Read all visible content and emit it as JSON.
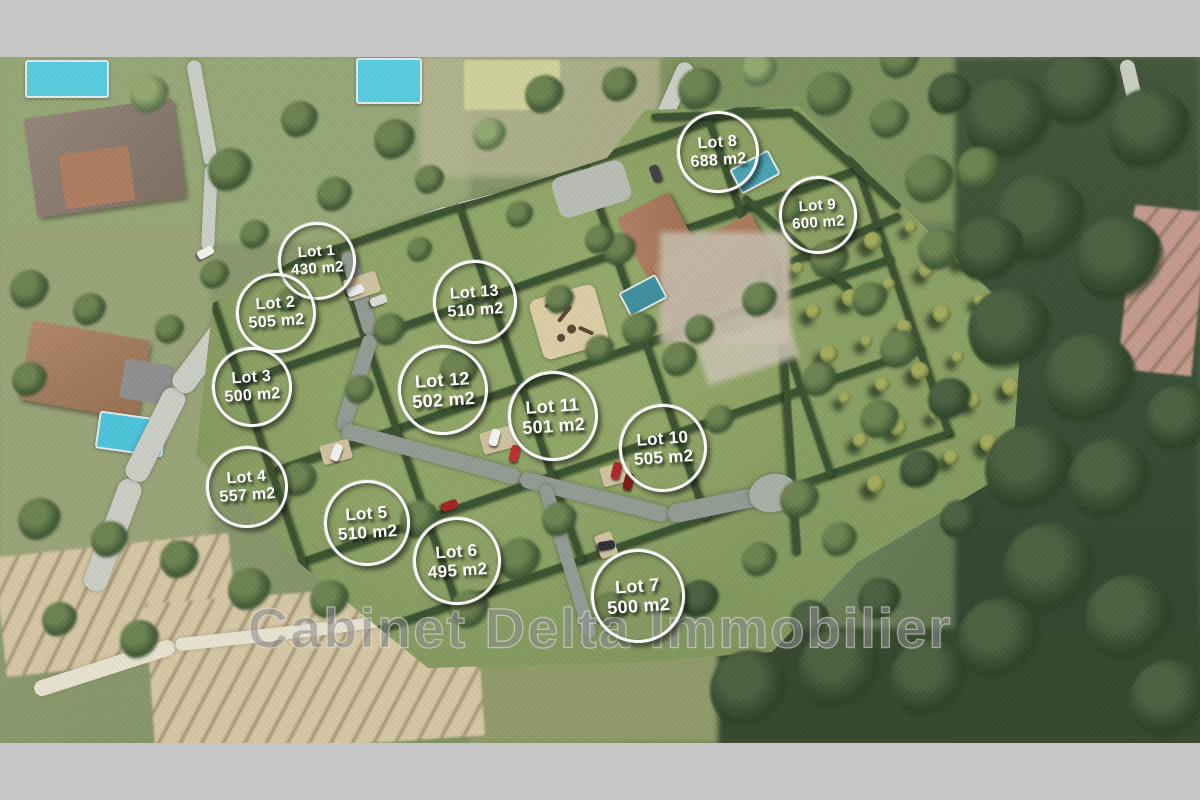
{
  "watermark": {
    "text": "Cabinet Delta Immobilier"
  },
  "lots": [
    {
      "label": "Lot 1",
      "area": "430 m2",
      "x": 317,
      "y": 261,
      "d": 72
    },
    {
      "label": "Lot 2",
      "area": "505 m2",
      "x": 276,
      "y": 313,
      "d": 74
    },
    {
      "label": "Lot 3",
      "area": "500 m2",
      "x": 252,
      "y": 387,
      "d": 74
    },
    {
      "label": "Lot 4",
      "area": "557 m2",
      "x": 247,
      "y": 487,
      "d": 76
    },
    {
      "label": "Lot 5",
      "area": "510 m2",
      "x": 367,
      "y": 523,
      "d": 80
    },
    {
      "label": "Lot 6",
      "area": "495 m2",
      "x": 457,
      "y": 561,
      "d": 82
    },
    {
      "label": "Lot 7",
      "area": "500 m2",
      "x": 638,
      "y": 596,
      "d": 88
    },
    {
      "label": "Lot 8",
      "area": "688 m2",
      "x": 718,
      "y": 152,
      "d": 76
    },
    {
      "label": "Lot 9",
      "area": "600 m2",
      "x": 818,
      "y": 215,
      "d": 72
    },
    {
      "label": "Lot 10",
      "area": "505 m2",
      "x": 663,
      "y": 448,
      "d": 82
    },
    {
      "label": "Lot 11",
      "area": "501 m2",
      "x": 553,
      "y": 416,
      "d": 84
    },
    {
      "label": "Lot 12",
      "area": "502 m2",
      "x": 443,
      "y": 390,
      "d": 84
    },
    {
      "label": "Lot 13",
      "area": "510 m2",
      "x": 475,
      "y": 302,
      "d": 78
    }
  ],
  "colors": {
    "frame": "#c6c6c6",
    "lawn": "#81985e",
    "hedge": "#3a5230",
    "forest": "#3f5638",
    "road_public": "#cbcec5",
    "road_internal": "#929c94",
    "field": "#d6c7a4",
    "pool": "#58cde0",
    "roof": "#ad7d60",
    "marker_ring": "#ffffff",
    "watermark": "#646464"
  }
}
